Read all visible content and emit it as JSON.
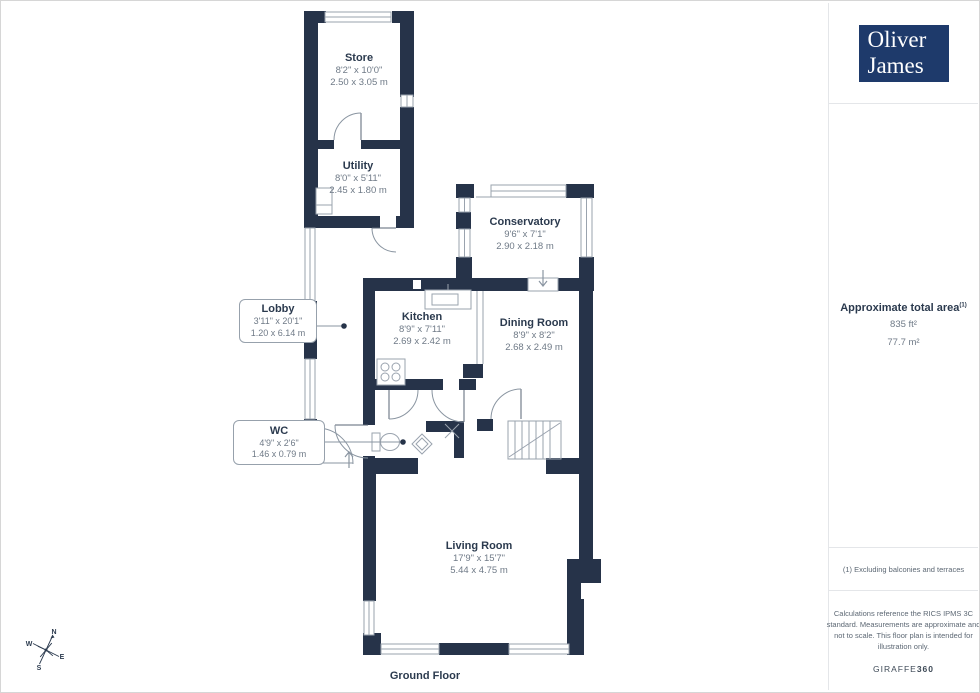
{
  "colors": {
    "wall": "#263349",
    "thin_line": "#9aa3ae",
    "room_text": "#2b3a4e",
    "dim_text": "#6f7a87",
    "logo_bg": "#1e3a6b",
    "divider": "#e4e6e9"
  },
  "branding": {
    "logo_line1": "Oliver",
    "logo_line2": "James"
  },
  "sidebar": {
    "area_title": "Approximate total area",
    "area_sup": "(1)",
    "area_ft": "835 ft²",
    "area_m": "77.7 m²",
    "footnote": "(1) Excluding balconies and terraces",
    "disclaimer": "Calculations reference the RICS IPMS 3C standard. Measurements are approximate and not to scale. This floor plan is intended for illustration only.",
    "brand": "GIRAFFE",
    "brand_suffix": "360"
  },
  "floorplan": {
    "floor_label": "Ground Floor",
    "compass": {
      "n": "N",
      "e": "E",
      "s": "S",
      "w": "W"
    },
    "rooms": [
      {
        "name": "Store",
        "imperial": "8'2\" x 10'0\"",
        "metric": "2.50 x 3.05 m"
      },
      {
        "name": "Utility",
        "imperial": "8'0\" x 5'11\"",
        "metric": "2.45 x 1.80 m"
      },
      {
        "name": "Conservatory",
        "imperial": "9'6\" x 7'1\"",
        "metric": "2.90 x 2.18 m"
      },
      {
        "name": "Kitchen",
        "imperial": "8'9\" x 7'11\"",
        "metric": "2.69 x 2.42 m"
      },
      {
        "name": "Dining Room",
        "imperial": "8'9\" x 8'2\"",
        "metric": "2.68 x 2.49 m"
      },
      {
        "name": "Lobby",
        "imperial": "3'11\" x 20'1\"",
        "metric": "1.20 x 6.14 m"
      },
      {
        "name": "WC",
        "imperial": "4'9\" x 2'6\"",
        "metric": "1.46 x 0.79 m"
      },
      {
        "name": "Living Room",
        "imperial": "17'9\" x 15'7\"",
        "metric": "5.44 x 4.75 m"
      }
    ]
  }
}
